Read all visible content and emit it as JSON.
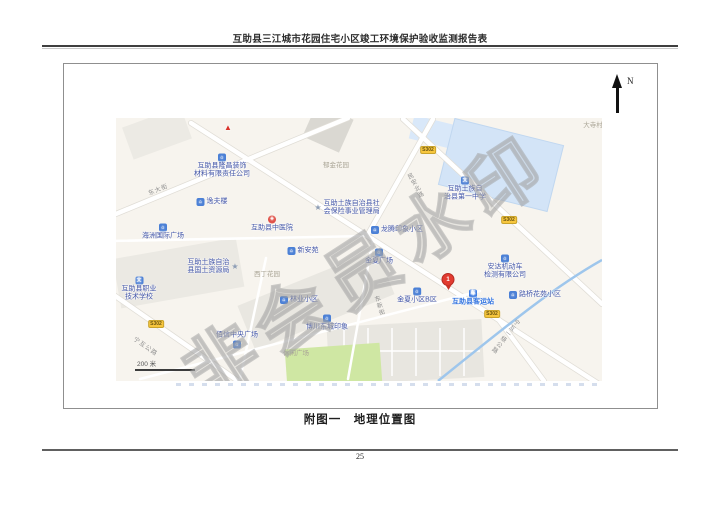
{
  "page": {
    "header_title": "互助县三江城市花园住宅小区竣工环境保护验收监测报告表",
    "caption": "附图一　地理位置图",
    "page_number": "25"
  },
  "compass": {
    "label": "N"
  },
  "watermark": {
    "text": "非会员水印"
  },
  "colors": {
    "map_background": "#f7f4ee",
    "poi_label": "#4356a8",
    "transit_accent": "#2f72e0",
    "area_label": "#aaa596",
    "road_label": "#8f8f8f",
    "badge_background": "#f7c63e",
    "school_area": "#d3e4f7",
    "park_area": "#cfe7a3",
    "river": "#9ec6ec",
    "pin_red": "#e23b30",
    "watermark_grey": "#b4b4b4",
    "north_arrow": "#111111"
  },
  "map": {
    "scale_bar": {
      "label": "200 米",
      "x": 19,
      "y": 240
    },
    "pin": {
      "label": "1",
      "x": 332,
      "y": 172
    },
    "road_badges": [
      {
        "text": "S302",
        "x": 312,
        "y": 32
      },
      {
        "text": "S302",
        "x": 393,
        "y": 102
      },
      {
        "text": "S302",
        "x": 376,
        "y": 196
      },
      {
        "text": "S302",
        "x": 40,
        "y": 206
      }
    ],
    "road_labels": [
      {
        "text": "东大街",
        "x": 42,
        "y": 71,
        "rotate": -22,
        "vertical": false
      },
      {
        "text": "民安北路",
        "x": 299,
        "y": 68,
        "rotate": -28,
        "vertical": true
      },
      {
        "text": "东新街",
        "x": 263,
        "y": 188,
        "rotate": -18,
        "vertical": true
      },
      {
        "text": "宁互公路",
        "x": 30,
        "y": 228,
        "rotate": 35,
        "vertical": false
      },
      {
        "text": "宁互一级公路",
        "x": 389,
        "y": 218,
        "rotate": 38,
        "vertical": true
      }
    ],
    "area_labels": [
      {
        "text": "郁金花园",
        "x": 220,
        "y": 46
      },
      {
        "text": "大寺村",
        "x": 477,
        "y": 6
      },
      {
        "text": "西丁花园",
        "x": 151,
        "y": 155
      },
      {
        "text": "休闲广场",
        "x": 180,
        "y": 234
      }
    ],
    "pois": [
      {
        "lines": [],
        "x": 112,
        "y": 10,
        "icon": "triangle",
        "iconPos": "above"
      },
      {
        "lines": [
          "互助县隆昌装饰",
          "材料有限责任公司"
        ],
        "x": 106,
        "y": 48,
        "icon": "building",
        "iconPos": "above"
      },
      {
        "lines": [
          "逸夫楼"
        ],
        "x": 96,
        "y": 84,
        "icon": "building",
        "iconPos": "left"
      },
      {
        "lines": [
          "互助县中医院"
        ],
        "x": 156,
        "y": 106,
        "icon": "hospital",
        "iconPos": "above"
      },
      {
        "lines": [
          "海洲国际广场"
        ],
        "x": 47,
        "y": 114,
        "icon": "building",
        "iconPos": "above"
      },
      {
        "lines": [
          "新安苑"
        ],
        "x": 187,
        "y": 133,
        "icon": "building",
        "iconPos": "left"
      },
      {
        "lines": [
          "互助土族自治",
          "县国土资源局"
        ],
        "x": 97,
        "y": 149,
        "icon": "star",
        "iconPos": "right"
      },
      {
        "lines": [
          "互助土族自治县社",
          "会保险事业管理局"
        ],
        "x": 231,
        "y": 90,
        "icon": "star",
        "iconPos": "left"
      },
      {
        "lines": [
          "龙腾印象小区"
        ],
        "x": 281,
        "y": 112,
        "icon": "building",
        "iconPos": "left"
      },
      {
        "lines": [
          "金夏广场"
        ],
        "x": 263,
        "y": 139,
        "icon": "building",
        "iconPos": "above"
      },
      {
        "lines": [
          "互助土族自",
          "治县第一中学"
        ],
        "x": 349,
        "y": 71,
        "icon": "school",
        "iconPos": "above"
      },
      {
        "lines": [
          "安达机动车",
          "检测有限公司"
        ],
        "x": 389,
        "y": 149,
        "icon": "building",
        "iconPos": "above"
      },
      {
        "lines": [
          "互助县客运站"
        ],
        "x": 357,
        "y": 180,
        "icon": "bus",
        "iconPos": "above",
        "accent": true
      },
      {
        "lines": [
          "金夏小区B区"
        ],
        "x": 301,
        "y": 178,
        "icon": "building",
        "iconPos": "above"
      },
      {
        "lines": [
          "路桥花苑小区"
        ],
        "x": 419,
        "y": 177,
        "icon": "building",
        "iconPos": "left"
      },
      {
        "lines": [
          "林业小区"
        ],
        "x": 183,
        "y": 182,
        "icon": "building",
        "iconPos": "left"
      },
      {
        "lines": [
          "博川东城印象"
        ],
        "x": 211,
        "y": 205,
        "icon": "building",
        "iconPos": "above"
      },
      {
        "lines": [
          "佰信中央广场"
        ],
        "x": 121,
        "y": 222,
        "icon": "building",
        "iconPos": "below"
      },
      {
        "lines": [
          "互助县职业",
          "技术学校"
        ],
        "x": 23,
        "y": 171,
        "icon": "school",
        "iconPos": "above"
      }
    ]
  }
}
